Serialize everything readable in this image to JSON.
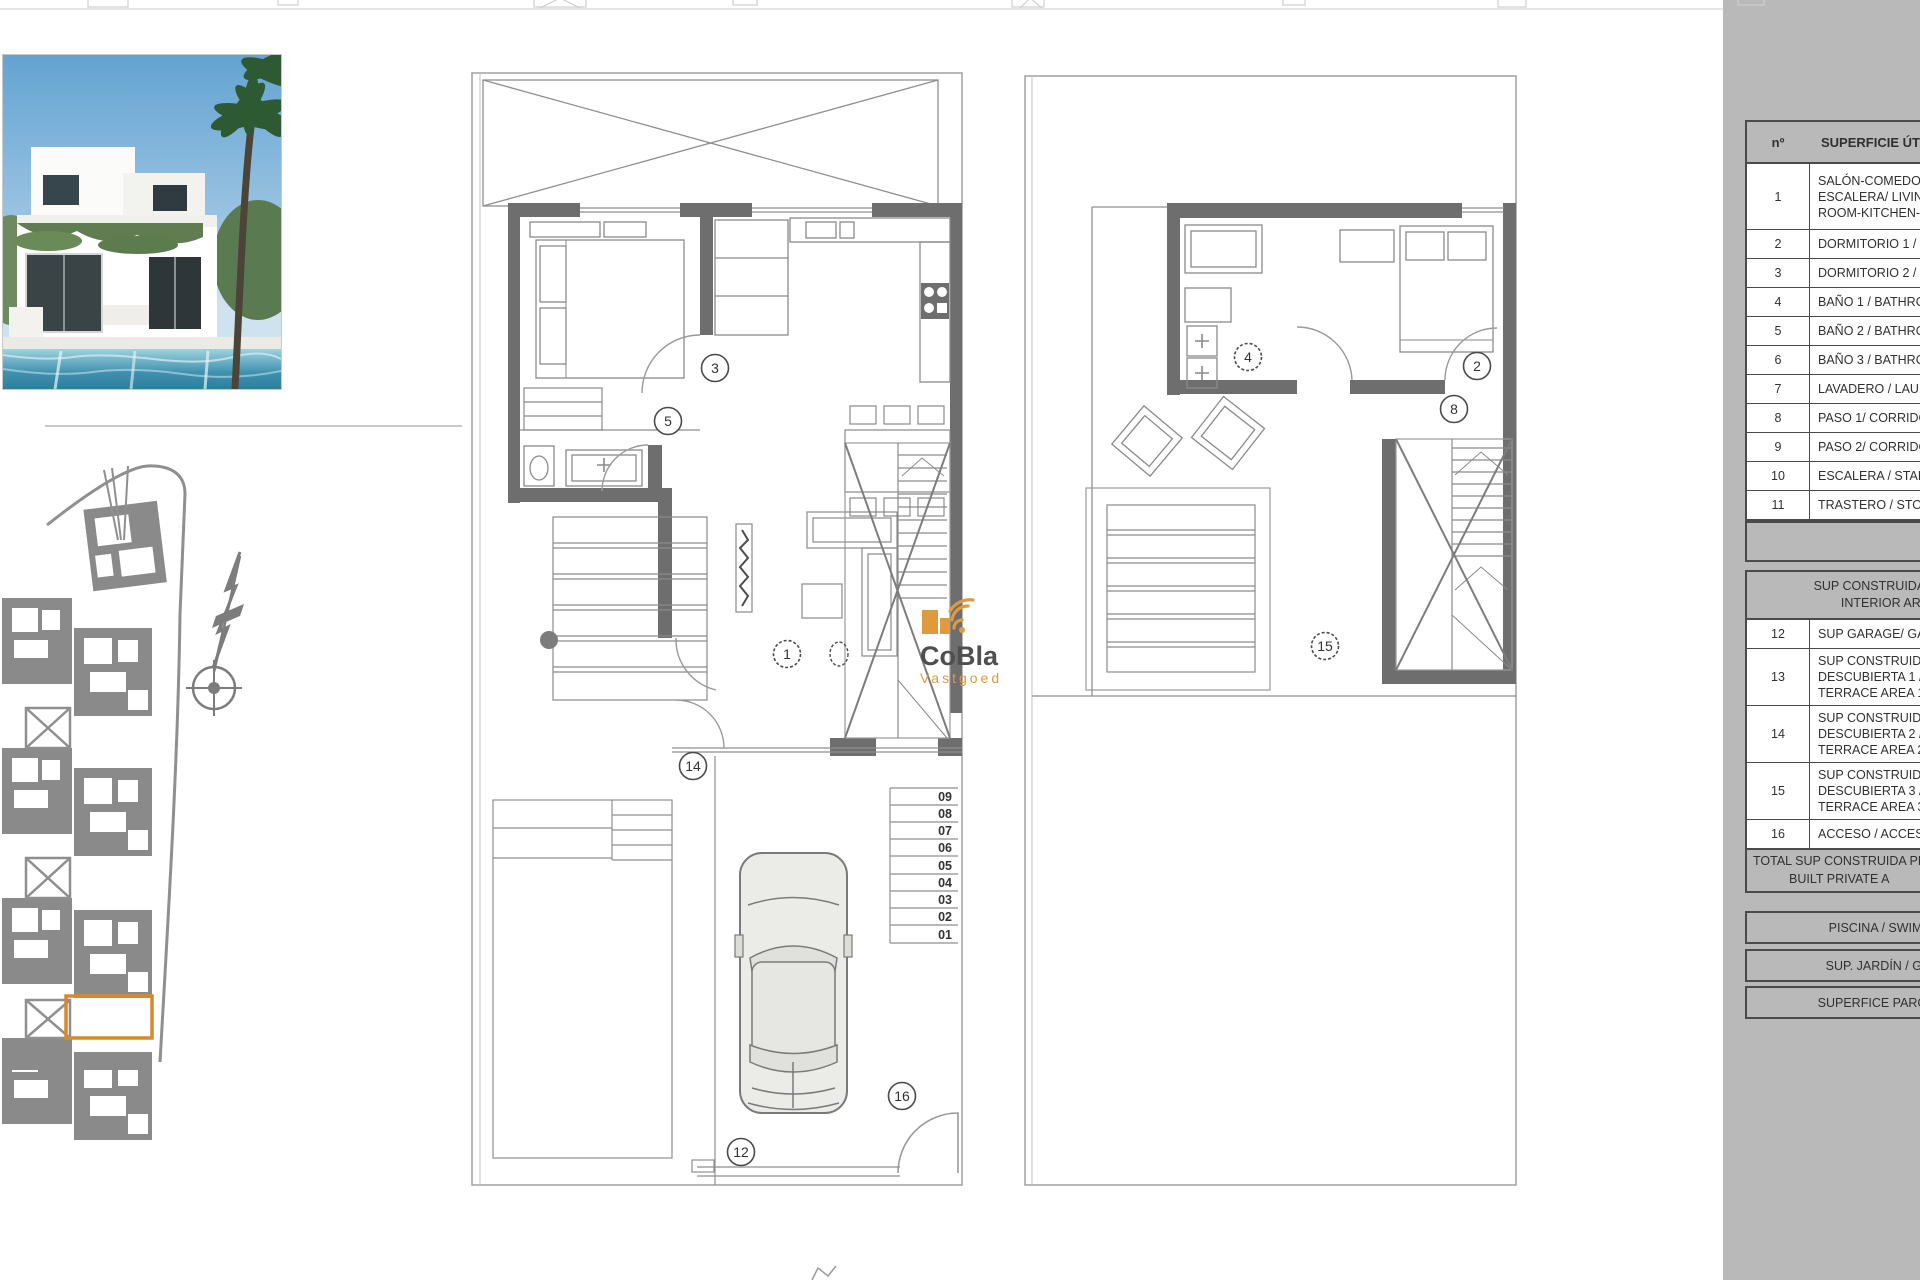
{
  "watermark": {
    "name": "CoBla",
    "sub": "Vastgoed",
    "accent": "#de9a3c"
  },
  "site_plan": {
    "highlight_color": "#d9892b"
  },
  "plan1": {
    "circles": {
      "c1": "1",
      "c3": "3",
      "c5": "5",
      "c12": "12",
      "c14": "14",
      "c16": "16"
    },
    "garage_numbers": [
      "09",
      "08",
      "07",
      "06",
      "05",
      "04",
      "03",
      "02",
      "01"
    ]
  },
  "plan2": {
    "circles": {
      "c2": "2",
      "c4": "4",
      "c8": "8",
      "c15": "15"
    }
  },
  "table": {
    "header": {
      "col_no": "nº",
      "col_label": "SUPERFICIE ÚTILE"
    },
    "rows": [
      {
        "no": "1",
        "lines": [
          "SALÓN-COMEDOR",
          "ESCALERA/ LIVIN",
          "ROOM-KITCHEN-"
        ]
      },
      {
        "no": "2",
        "lines": [
          "DORMITORIO 1 /"
        ]
      },
      {
        "no": "3",
        "lines": [
          "DORMITORIO 2 /"
        ]
      },
      {
        "no": "4",
        "lines": [
          "BAÑO 1 / BATHRO"
        ]
      },
      {
        "no": "5",
        "lines": [
          "BAÑO 2 / BATHRO"
        ]
      },
      {
        "no": "6",
        "lines": [
          "BAÑO 3 / BATHRO"
        ]
      },
      {
        "no": "7",
        "lines": [
          "LAVADERO / LAU"
        ]
      },
      {
        "no": "8",
        "lines": [
          "PASO 1/ CORRIDO"
        ]
      },
      {
        "no": "9",
        "lines": [
          "PASO 2/ CORRIDO"
        ]
      },
      {
        "no": "10",
        "lines": [
          "ESCALERA / STAIR"
        ]
      },
      {
        "no": "11",
        "lines": [
          "TRASTERO / STOR"
        ]
      }
    ],
    "interior_header": [
      "SUP CONSTRUIDA INTE",
      "INTERIOR ARE"
    ],
    "rows2": [
      {
        "no": "12",
        "lines": [
          "SUP GARAGE/ GA"
        ]
      },
      {
        "no": "13",
        "lines": [
          "SUP CONSTRUIDA",
          "DESCUBIERTA 1 /",
          "TERRACE AREA 1"
        ]
      },
      {
        "no": "14",
        "lines": [
          "SUP CONSTRUIDA",
          "DESCUBIERTA 2 /",
          "TERRACE AREA 2"
        ]
      },
      {
        "no": "15",
        "lines": [
          "SUP CONSTRUIDA",
          "DESCUBIERTA 3 /",
          "TERRACE AREA 3"
        ]
      },
      {
        "no": "16",
        "lines": [
          "ACCESO / ACCESS"
        ]
      }
    ],
    "total": [
      "TOTAL SUP CONSTRUIDA PR",
      "BUILT PRIVATE A"
    ],
    "bars": [
      "PISCINA / SWIMMIN",
      "SUP. JARDÍN / GARD",
      "SUPERFICE PARCELA /"
    ]
  }
}
